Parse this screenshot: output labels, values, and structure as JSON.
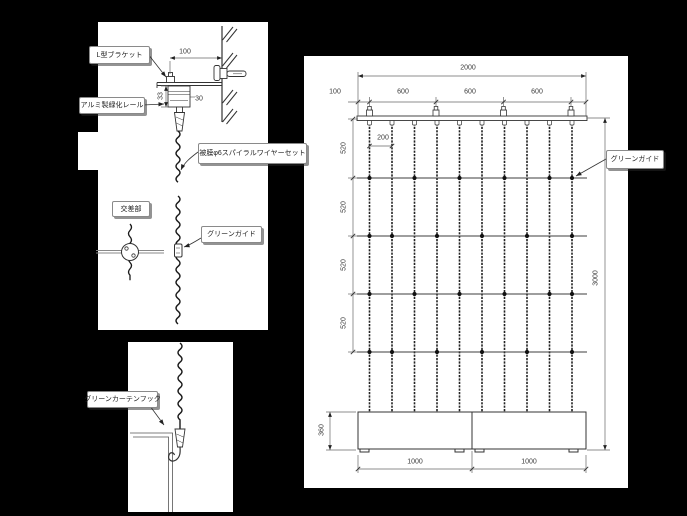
{
  "detail_top": {
    "l_bracket_label": "L型ブラケット",
    "alumi_rail_label": "アルミ製緑化レール",
    "spiral_wire_label": "被膜φ6スパイラルワイヤーセット",
    "crossing_label": "交差部",
    "green_guide_label": "グリーンガイド",
    "dim_depth": "100",
    "dim_rail_h": "33",
    "dim_rail_w": "30"
  },
  "detail_bottom": {
    "hook_label": "グリーンカーテンフック"
  },
  "elevation": {
    "green_guide_label": "グリーンガイド",
    "dim_overall_w": "2000",
    "dim_end": "100",
    "dim_pitch": [
      "600",
      "600",
      "600"
    ],
    "dim_wire_pitch": "200",
    "dim_rows": [
      "520",
      "520",
      "520",
      "520"
    ],
    "dim_overall_h": "3000",
    "dim_planter_h": "360",
    "dim_planters": [
      "1000",
      "1000"
    ]
  }
}
